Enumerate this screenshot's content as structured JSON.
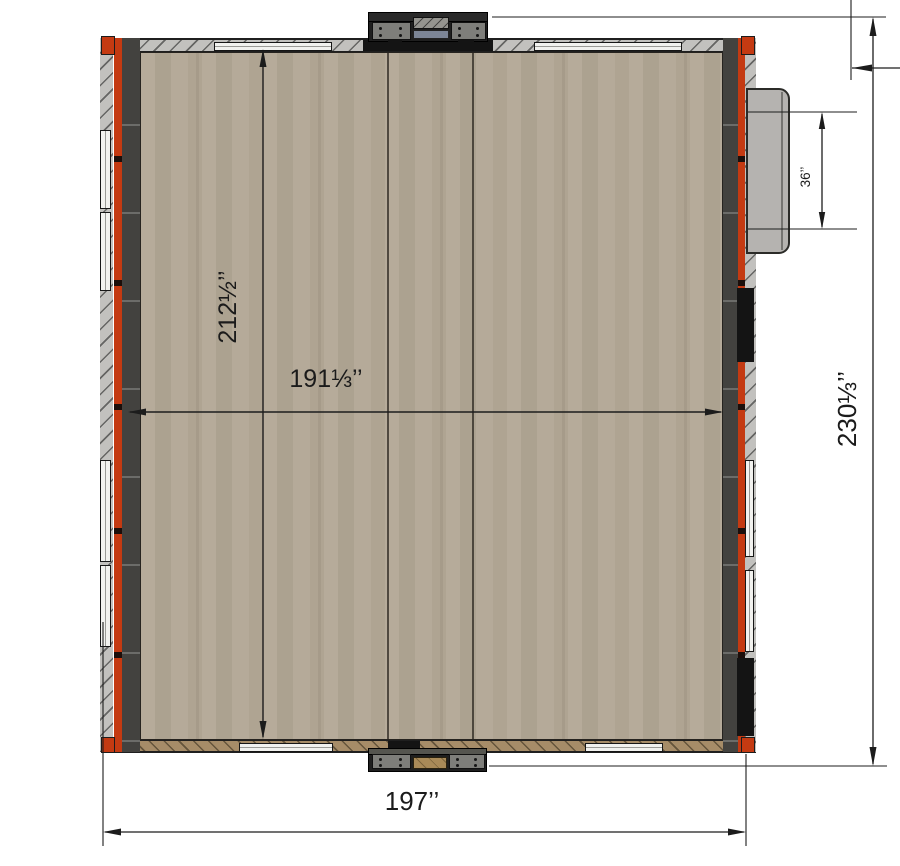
{
  "dimensions": {
    "floor_length": {
      "label": "212½’’"
    },
    "floor_width": {
      "label": "191⅓’’"
    },
    "side_door_opening": {
      "label": "36’’"
    },
    "overall_length": {
      "label": "230⅓’’"
    },
    "overall_width": {
      "label": "197’’"
    }
  },
  "colors": {
    "background": "#ffffff",
    "floor": "#b2a795",
    "wall_dark": "#43423f",
    "frame_red": "#c43a12",
    "panel_gray": "#c2c1be",
    "door_gray": "#b5b3b0",
    "bottom_band": "#a68c68",
    "dimension_line": "#1c1c1c"
  }
}
